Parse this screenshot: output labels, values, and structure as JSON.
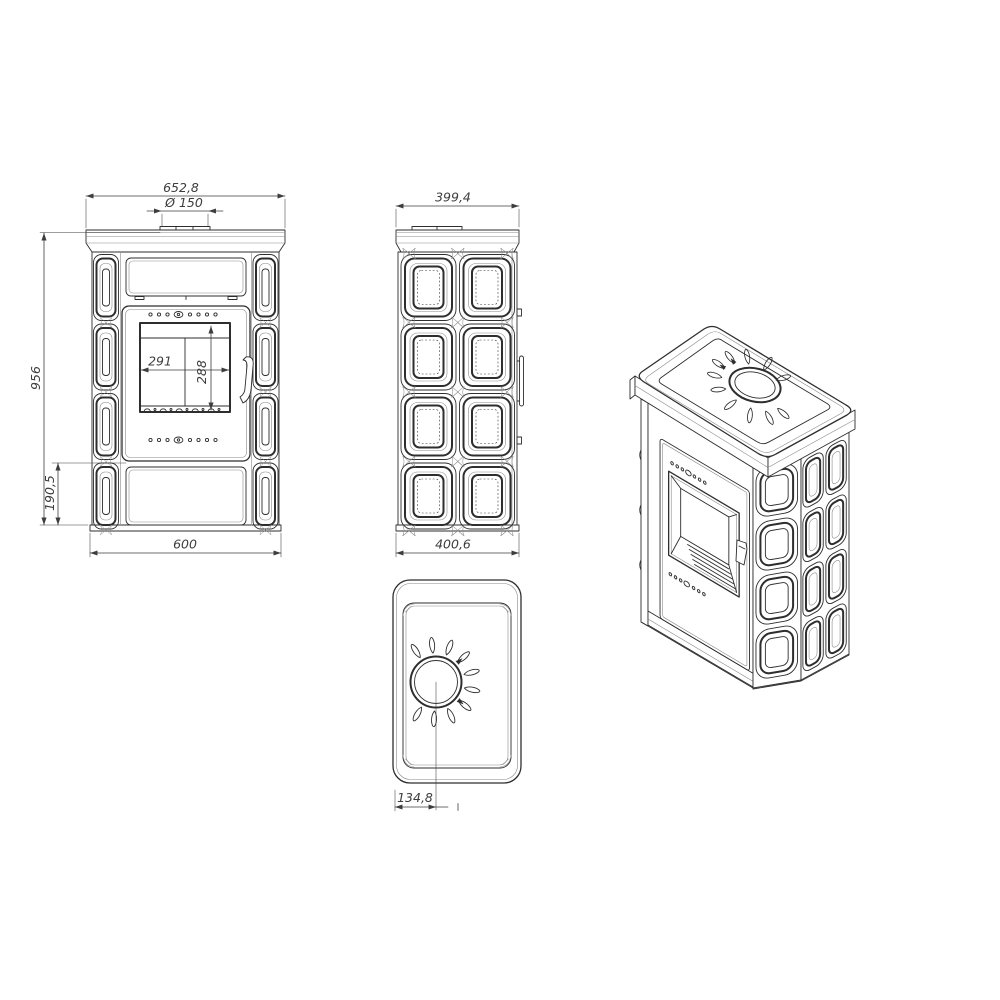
{
  "front_view": {
    "dim_width_top": "652,8",
    "dim_flue_diameter": "Ø 150",
    "dim_height": "956",
    "dim_ash_height": "190,5",
    "dim_glass_width": "291",
    "dim_glass_height": "288",
    "dim_width_bottom": "600"
  },
  "side_view": {
    "dim_depth_top": "399,4",
    "dim_depth_bottom": "400,6"
  },
  "top_view": {
    "dim_flue_offset": "134,8"
  },
  "colors": {
    "line": "#2e2e2e",
    "line_light": "#8a8a8a",
    "dim": "#3d3d3d",
    "bg": "#ffffff"
  }
}
